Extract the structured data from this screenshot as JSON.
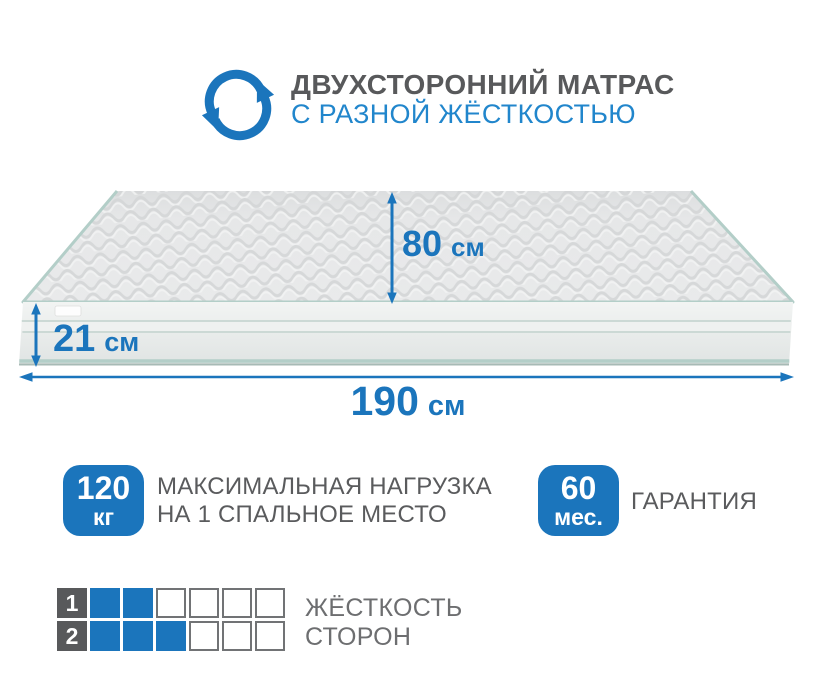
{
  "colors": {
    "accent": "#1b75bc",
    "subtitle_blue": "#2186cc",
    "title_gray": "#58595b",
    "text_gray": "#5a5b5d",
    "muted_gray": "#6d6e70",
    "square_border": "#717375",
    "mattress_edge_teal": "#b3cec8",
    "mattress_top_gray": "#e6e7e8"
  },
  "header": {
    "icon": "rotate-arrows-icon",
    "title": "ДВУХСТОРОННИЙ МАТРАС",
    "subtitle": "С РАЗНОЙ ЖЁСТКОСТЬЮ"
  },
  "dimensions": {
    "depth_value": "80",
    "depth_unit": "см",
    "height_value": "21",
    "height_unit": "см",
    "length_value": "190",
    "length_unit": "см"
  },
  "features": [
    {
      "badge_value": "120",
      "badge_unit": "кг",
      "label_line1": "МАКСИМАЛЬНАЯ НАГРУЗКА",
      "label_line2": "НА 1 СПАЛЬНОЕ МЕСТО"
    },
    {
      "badge_value": "60",
      "badge_unit": "мес.",
      "label_line1": "ГАРАНТИЯ",
      "label_line2": ""
    }
  ],
  "hardness": {
    "label_line1": "ЖЁСТКОСТЬ",
    "label_line2": "СТОРОН",
    "rows": [
      {
        "index": "1",
        "filled": 2,
        "total": 6
      },
      {
        "index": "2",
        "filled": 3,
        "total": 6
      }
    ]
  }
}
